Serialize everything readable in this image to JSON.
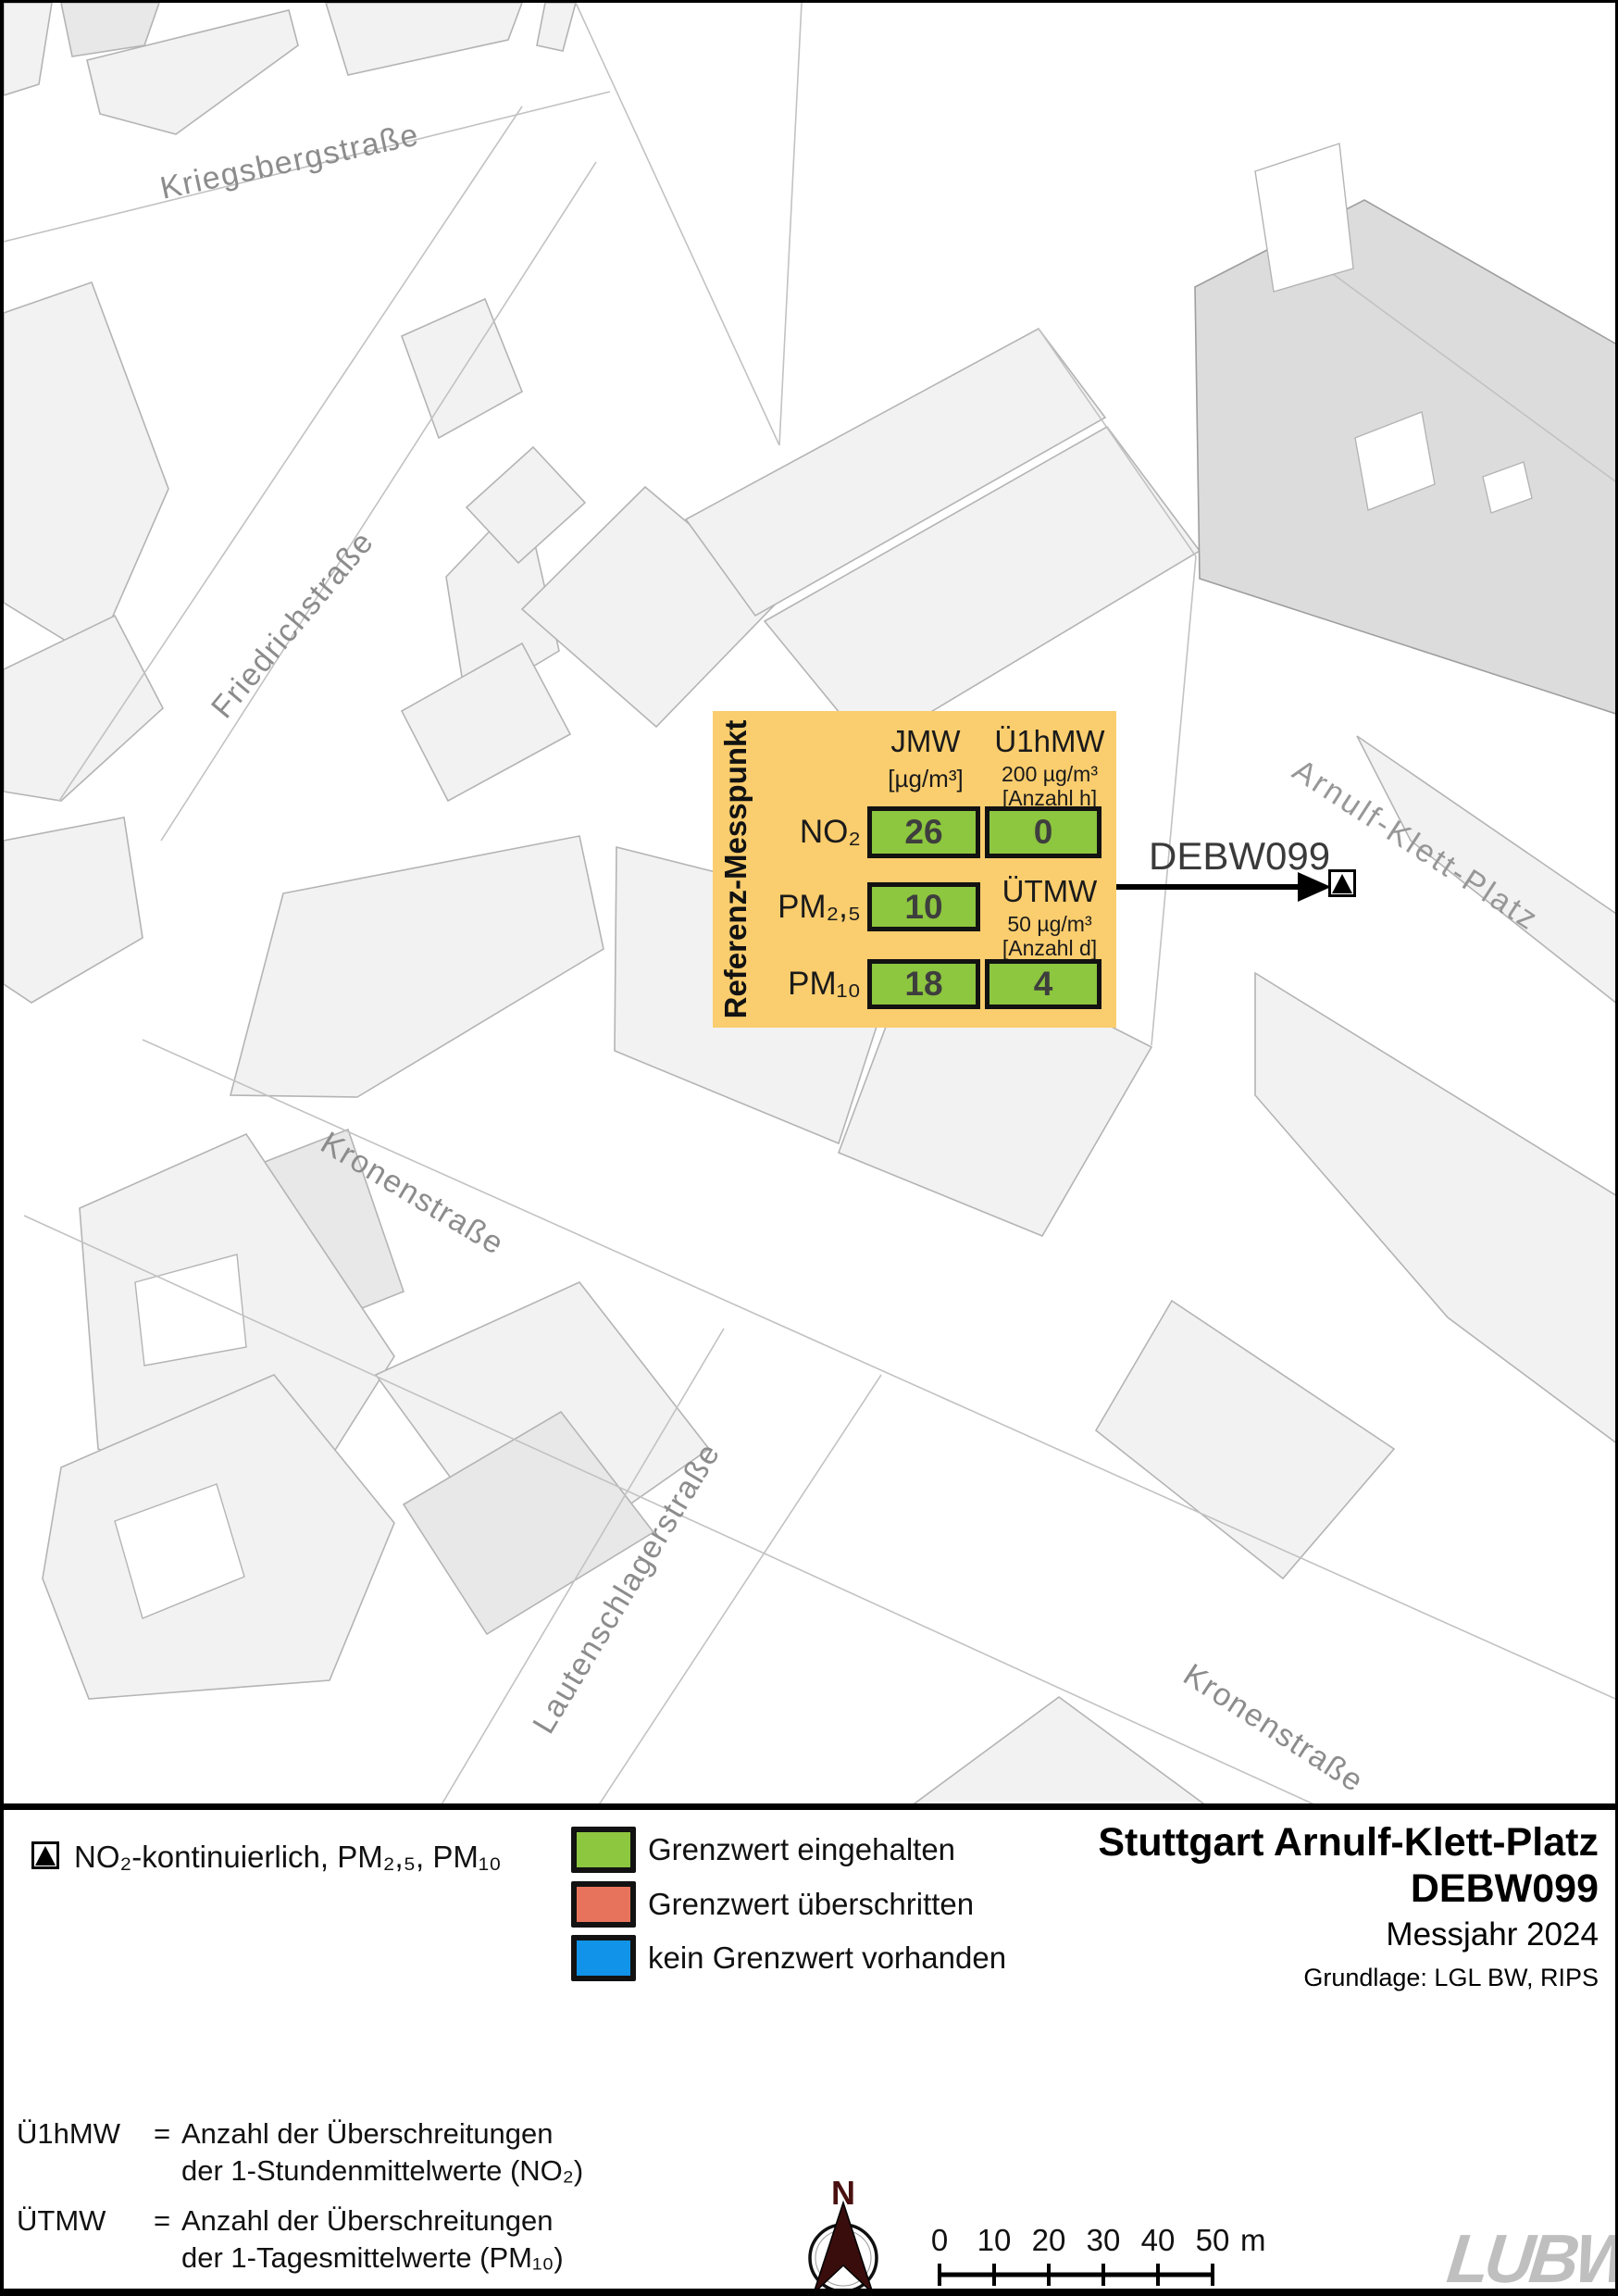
{
  "map": {
    "streets": [
      {
        "name": "Kriegsbergstraße"
      },
      {
        "name": "Friedrichstraße"
      },
      {
        "name": "Arnulf-Klett-Platz"
      },
      {
        "name": "Kronenstraße"
      },
      {
        "name": "Lautenschlagerstraße"
      },
      {
        "name": "Kronenstraße"
      }
    ]
  },
  "info_box": {
    "side_label": "Referenz-Messpunkt",
    "col_jmw": {
      "header": "JMW",
      "unit": "[µg/m³]"
    },
    "col_u1hmw": {
      "header": "Ü1hMW",
      "limit": "200 µg/m³",
      "unit": "[Anzahl h]"
    },
    "col_utmw": {
      "header": "ÜTMW",
      "limit": "50 µg/m³",
      "unit": "[Anzahl d]"
    },
    "rows": [
      {
        "pollutant": "NO₂",
        "jmw": "26",
        "exceed": "0"
      },
      {
        "pollutant": "PM₂,₅",
        "jmw": "10"
      },
      {
        "pollutant": "PM₁₀",
        "jmw": "18",
        "exceed": "4"
      }
    ]
  },
  "station": {
    "id": "DEBW099"
  },
  "legend": {
    "marker_label": "NO₂-kontinuierlich, PM₂,₅, PM₁₀",
    "items": [
      {
        "label": "Grenzwert eingehalten",
        "color": "#8DC63F"
      },
      {
        "label": "Grenzwert überschritten",
        "color": "#E8735C"
      },
      {
        "label": "kein Grenzwert vorhanden",
        "color": "#1093E8"
      }
    ]
  },
  "title_block": {
    "line1": "Stuttgart Arnulf-Klett-Platz",
    "line2": "DEBW099",
    "line3": "Messjahr 2024",
    "line4": "Grundlage: LGL BW, RIPS"
  },
  "footnotes": [
    {
      "term": "Ü1hMW",
      "sign": "=",
      "line1": "Anzahl der Überschreitungen",
      "line2": "der 1-Stundenmittelwerte (NO₂)"
    },
    {
      "term": "ÜTMW",
      "sign": "=",
      "line1": "Anzahl der Überschreitungen",
      "line2": "der 1-Tagesmittelwerte (PM₁₀)"
    }
  ],
  "north": {
    "label": "N"
  },
  "scalebar": {
    "ticks": [
      "0",
      "10",
      "20",
      "30",
      "40",
      "50"
    ],
    "unit": "m"
  },
  "logo": {
    "text": "LUBW"
  },
  "colors": {
    "box_bg": "#FACD6E",
    "cell_green": "#8DC63F",
    "building": "#F2F2F2",
    "building_dark": "#DCDCDC",
    "street_label": "#8C8C8C",
    "north_arrow": "#3A0D0D",
    "logo_gray": "#BFBFBF"
  }
}
